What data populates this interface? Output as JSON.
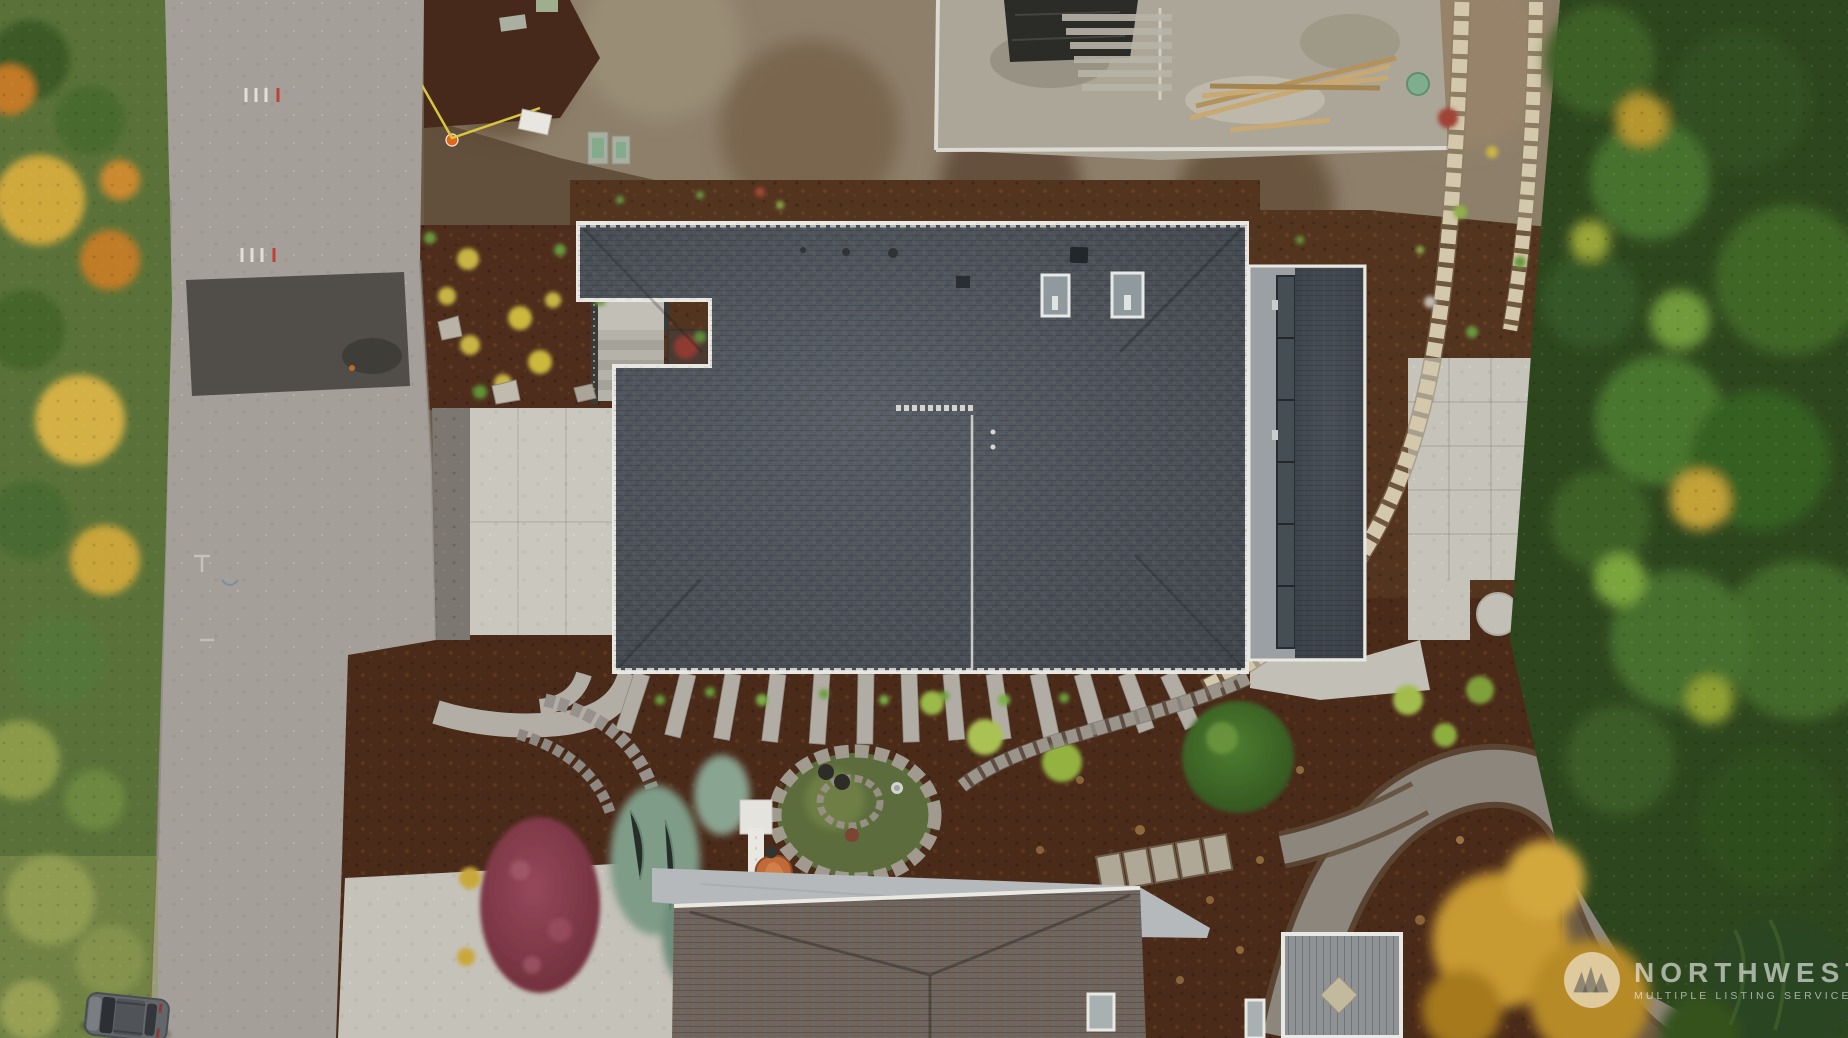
{
  "watermark": {
    "brand": "NORTHWEST",
    "tagline": "MULTIPLE LISTING SERVICE®",
    "logo_icon": "mountain-peaks-icon",
    "color": "#ffffff",
    "opacity": 0.58
  },
  "photo": {
    "type": "aerial-drone-top-down",
    "subject": "new construction home with dark composition shingle roof, concrete driveway, landscaped beds and neighboring houses",
    "regions": [
      "street-left",
      "autumn-foliage-strip",
      "parked-car",
      "construction-lot-top",
      "main-house-roof",
      "skylights",
      "entry-stairs",
      "driveway",
      "mulch-planting-beds",
      "fan-walkway-steps",
      "stone-circle-garden",
      "japanese-maple",
      "juniper-shrubs",
      "tarp-covered-equipment",
      "wheelbarrow",
      "garden-hose",
      "side-patio",
      "block-retaining-walls",
      "gravel-path",
      "neighbor-house-roof",
      "wood-deck",
      "evergreen-forest-right",
      "golden-trees"
    ],
    "palette": {
      "asphalt": "#a49f98",
      "asphalt_patch": "#514e49",
      "concrete": "#cac7be",
      "main_roof": "#4d535a",
      "neighbor_roof": "#6e655e",
      "mulch": "#53341f",
      "dirt": "#8d7f6a",
      "forest_green": "#2e461e",
      "autumn_yellow": "#d4b044",
      "autumn_orange": "#c27a25",
      "maple_red": "#7c3340",
      "tarp_teal": "#6ba3a4",
      "wheelbarrow_orange": "#c06a38"
    }
  }
}
